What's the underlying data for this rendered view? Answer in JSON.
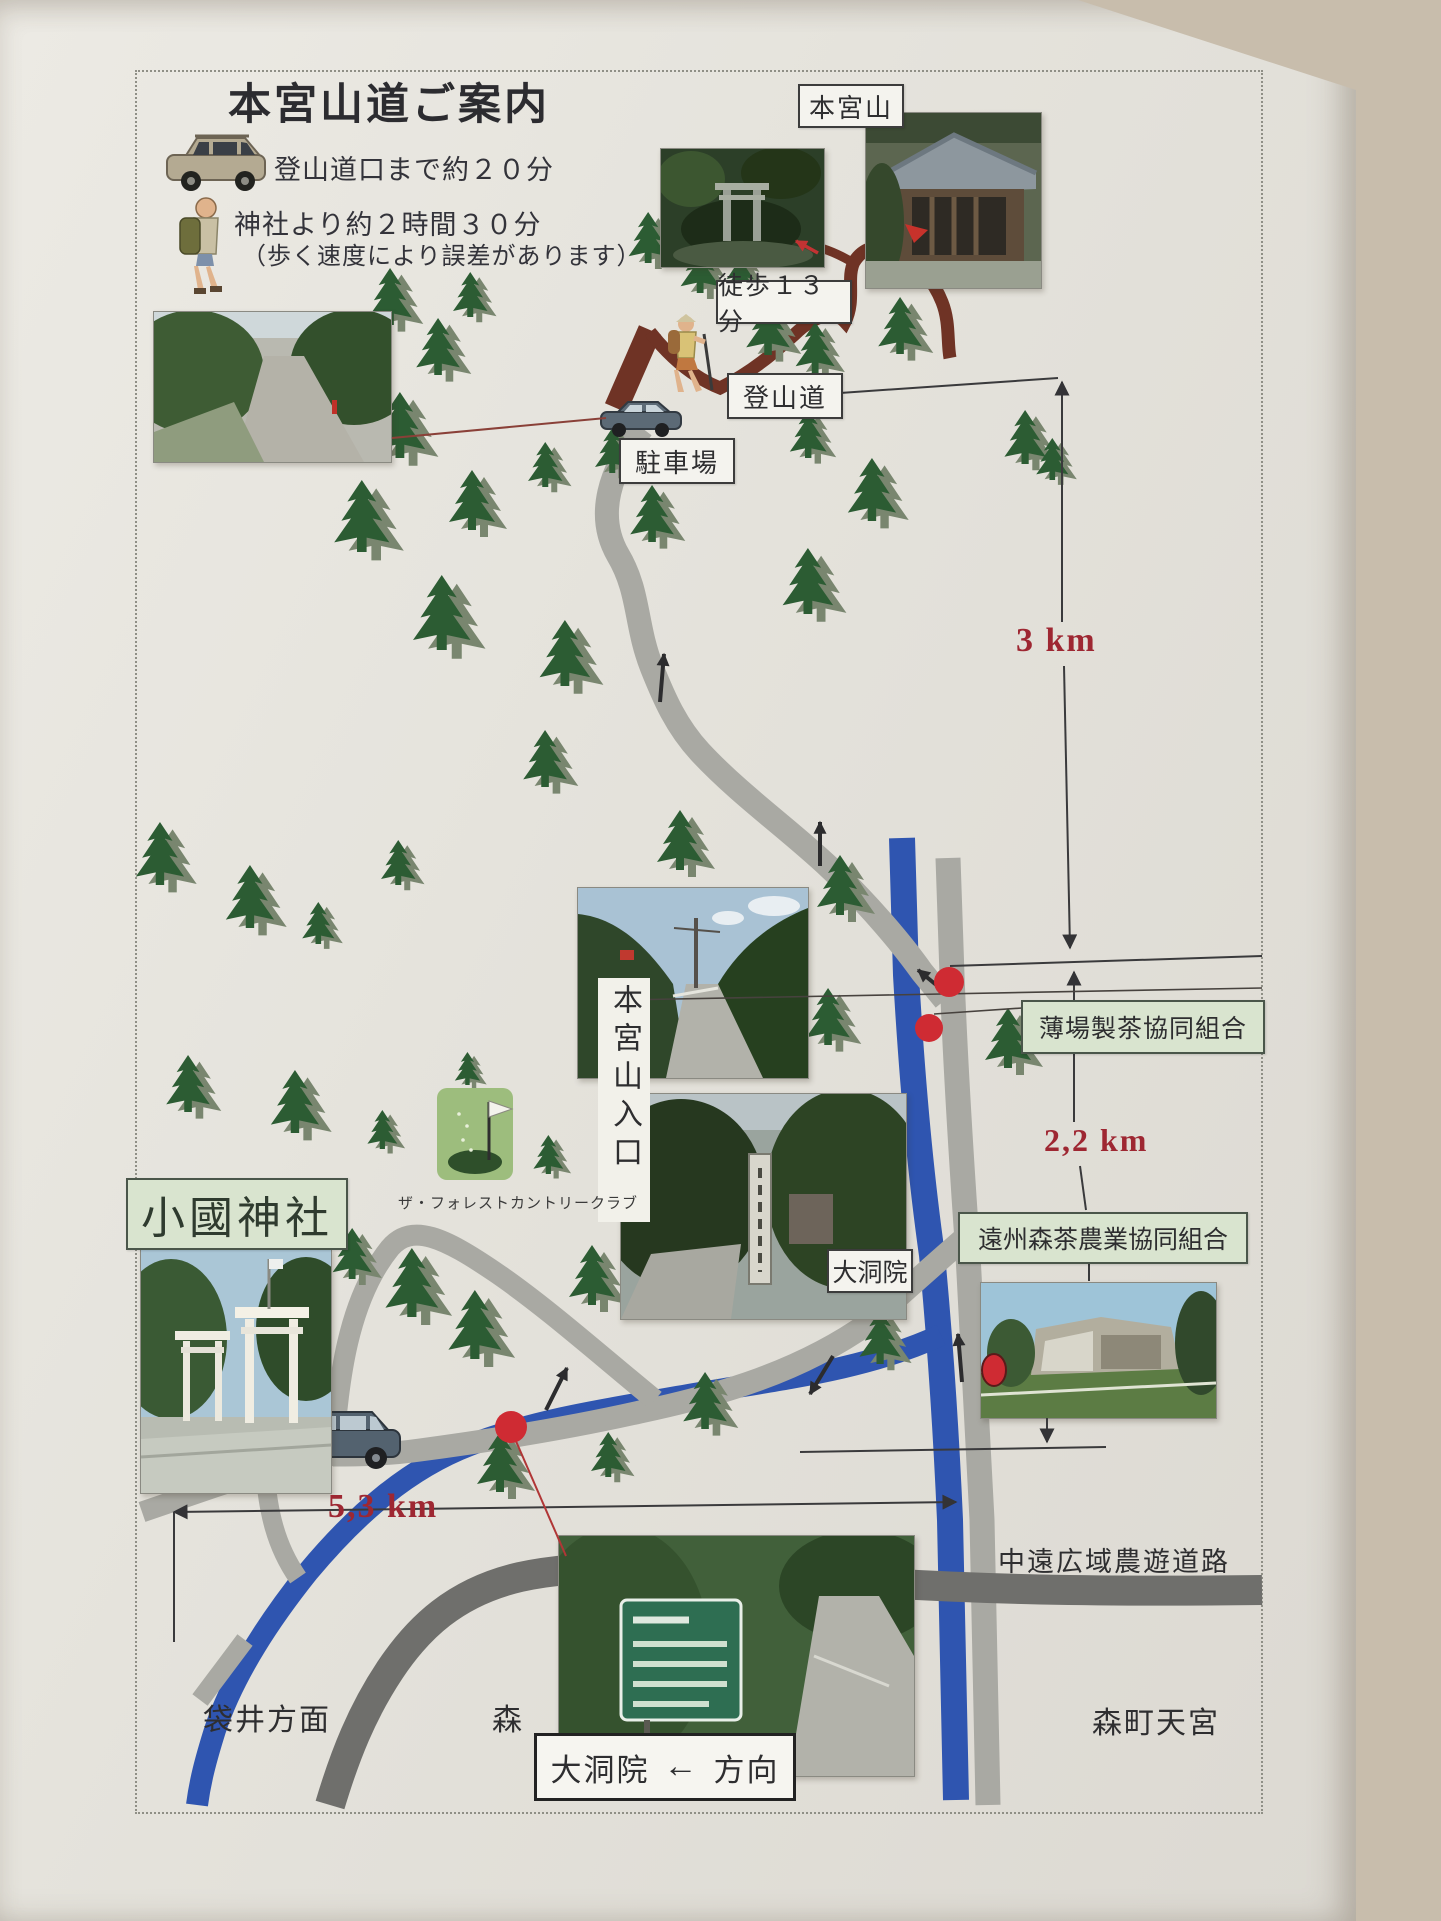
{
  "title": "本宮山道ご案内",
  "legend": {
    "car_note": "登山道口まで約２０分",
    "walk_note": "神社より約２時間３０分",
    "walk_note_sub": "（歩く速度により誤差があります）"
  },
  "map_labels": {
    "summit": "本宮山",
    "walk_13min": "徒歩１３分",
    "trailhead": "登山道",
    "parking": "駐車場",
    "mountain_entrance": "本宮山入口",
    "usuba_tea": "薄場製茶協同組合",
    "daitoin": "大洞院",
    "enshu_tea": "遠州森茶農業協同組合",
    "okuni_shrine": "小國神社",
    "golf_club": "ザ・フォレストカントリークラブ",
    "chuen_road": "中遠広域農遊道路"
  },
  "distances": {
    "trailhead_section": "3 km",
    "middle_section": "2,2 km",
    "okuni_section": "5,3 km"
  },
  "bottom_labels": {
    "fukuroi": "袋井方面",
    "mori": "森",
    "direction_place": "大洞院",
    "direction_arrow": "←",
    "direction_suffix": "方向",
    "morimachi_tengu": "森町天宮"
  },
  "colors": {
    "distance_red": "#9e2732",
    "river_blue": "#2f55b0",
    "road_gray": "#a9a9a3",
    "highway_gray": "#6f6f6c",
    "trail_brown": "#6f3325",
    "tree_green": "#2c5c33",
    "label_green_bg": "#d9e4cf",
    "marker_red": "#cf2b33"
  }
}
